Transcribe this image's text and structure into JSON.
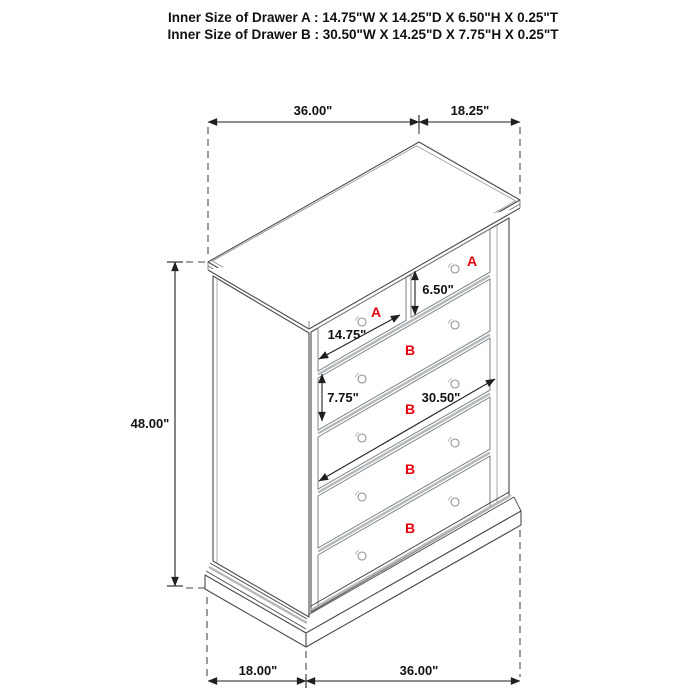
{
  "header": {
    "line1": "Inner Size of Drawer A : 14.75\"W X 14.25\"D X 6.50\"H X 0.25\"T",
    "line2": "Inner Size of Drawer B : 30.50\"W X 14.25\"D X 7.75\"H X 0.25\"T"
  },
  "dimensions": {
    "top_width": "36.00\"",
    "top_depth": "18.25\"",
    "height": "48.00\"",
    "bottom_depth": "18.00\"",
    "bottom_width": "36.00\"",
    "drawer_a_width": "14.75\"",
    "drawer_a_height": "6.50\"",
    "drawer_b_height": "7.75\"",
    "drawer_b_width": "30.50\""
  },
  "drawer_labels": {
    "a": "A",
    "b": "B"
  },
  "colors": {
    "label_red": "#e8000d",
    "line_dark": "#4a4a4a",
    "line_gray": "#b4b8bb",
    "dim_text": "#111111"
  }
}
